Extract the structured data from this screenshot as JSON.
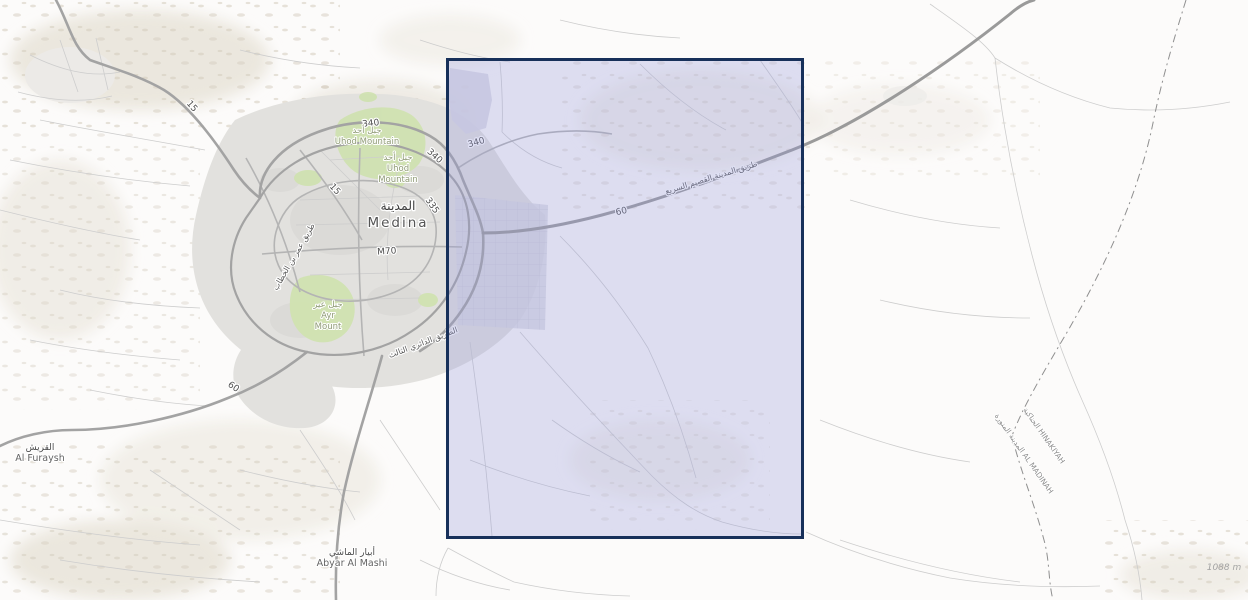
{
  "map_type": "street-topographic-map",
  "colors": {
    "background": "#fcfbfa",
    "selection_border": "#17305a",
    "selection_fill": "#949cdc",
    "urban_area": "#e2e1de",
    "green_area": "#cfe2ae",
    "major_road": "#a3a3a3",
    "medium_road": "#b4b4b4",
    "minor_road": "#cdcdcd",
    "boundary_line": "#8f8f8f"
  },
  "places": {
    "city": {
      "ar": "المدينة",
      "en": "Medina"
    },
    "uhod_outer": {
      "ar": "جبل أحد",
      "en": "Uhod Mountain"
    },
    "uhod_inner": {
      "ar": "جبل أحد",
      "en1": "Uhod",
      "en2": "Mountain"
    },
    "ayr": {
      "ar": "جبل عير",
      "en1": "Ayr",
      "en2": "Mount"
    },
    "furaysh": {
      "ar": "القريش",
      "en": "Al Furaysh"
    },
    "abyar": {
      "ar": "أبيار الماشي",
      "en": "Abyar Al Mashi"
    }
  },
  "roads": {
    "shield_15_nw": "15",
    "shield_15_city": "15",
    "shield_340_w": "340",
    "shield_340_mid": "340",
    "shield_340_e": "340",
    "shield_335": "335",
    "shield_m70": "M70",
    "shield_60_e": "60",
    "shield_60_sw": "60",
    "expressway_name_ar": "طريق المدينة القصيم السريع",
    "omar_road_ar": "طريق عمر بن الخطاب",
    "third_ring_ar": "الطريق الدائري الثالث"
  },
  "boundary": {
    "east_label": "الحناكية HINAKIYAH",
    "west_label": "المدينة المنورة AL MADINAH"
  },
  "annotations": {
    "elevation": "1088 m"
  }
}
